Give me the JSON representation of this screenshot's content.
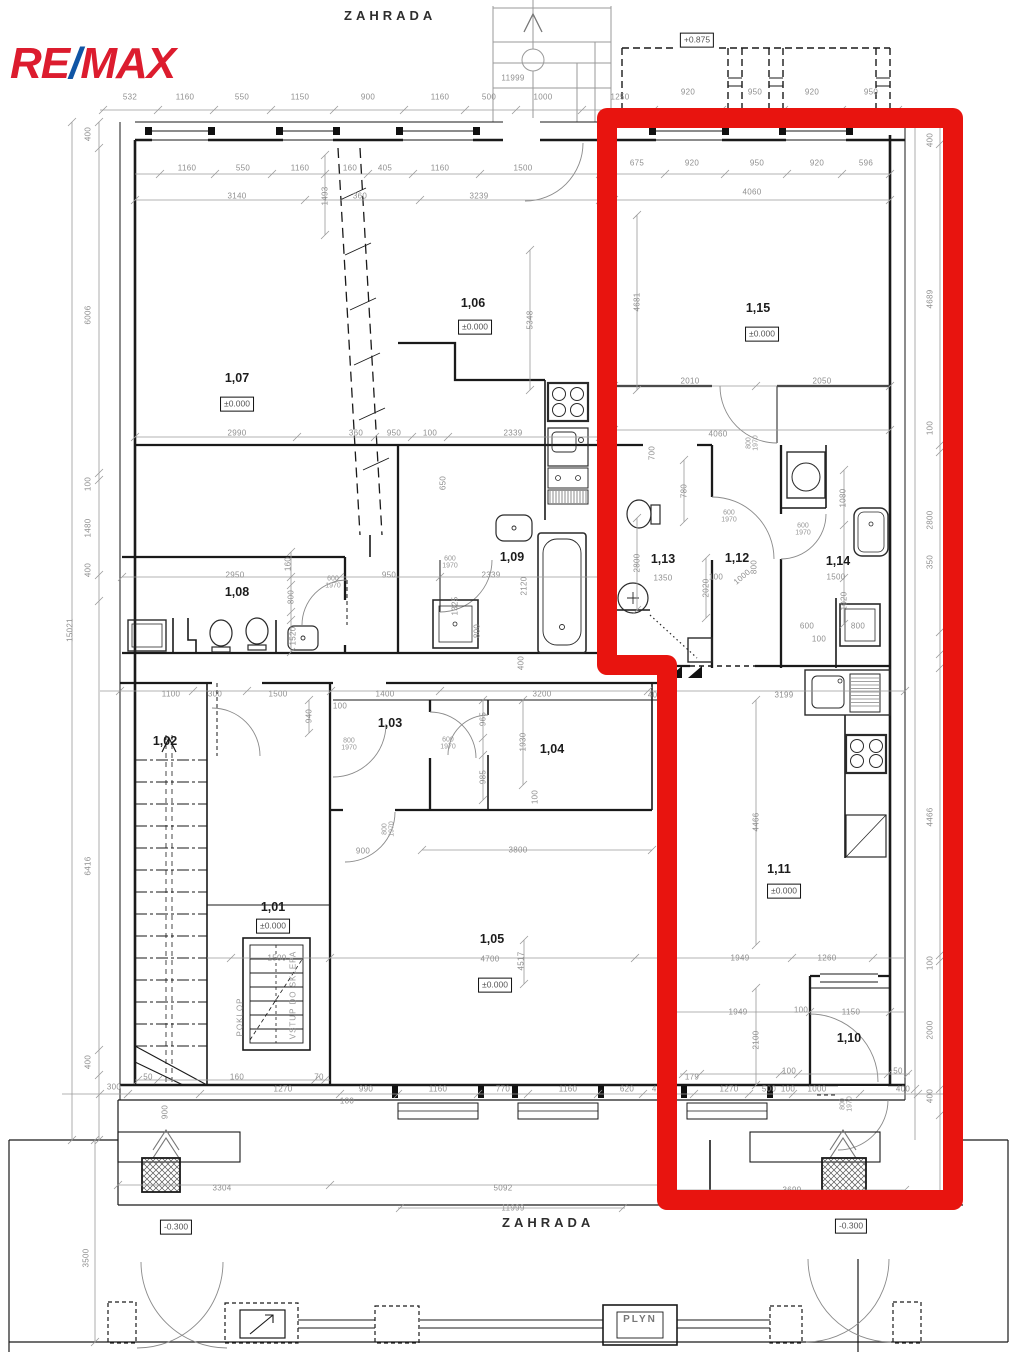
{
  "logo": {
    "re": "RE",
    "slash": "/",
    "max": "MAX"
  },
  "labels": {
    "garden_top": "ZAHRADA",
    "garden_bottom": "ZAHRADA",
    "gas_box": "PLYN"
  },
  "colors": {
    "highlight": "#e8140f",
    "logo_red": "#dc1c2e",
    "logo_blue": "#1055a5",
    "wall": "#1a1a1a",
    "dim": "#9a9a9a"
  },
  "annotations": [
    {
      "t": "1,07",
      "x": 237,
      "y": 378,
      "k": "room"
    },
    {
      "t": "±0.000",
      "x": 237,
      "y": 404,
      "k": "level"
    },
    {
      "t": "1,06",
      "x": 473,
      "y": 303,
      "k": "room"
    },
    {
      "t": "±0.000",
      "x": 475,
      "y": 327,
      "k": "level"
    },
    {
      "t": "1,15",
      "x": 758,
      "y": 308,
      "k": "room"
    },
    {
      "t": "±0.000",
      "x": 762,
      "y": 334,
      "k": "level"
    },
    {
      "t": "1,08",
      "x": 237,
      "y": 592,
      "k": "room"
    },
    {
      "t": "1,09",
      "x": 512,
      "y": 557,
      "k": "room"
    },
    {
      "t": "1,13",
      "x": 663,
      "y": 559,
      "k": "room"
    },
    {
      "t": "1,12",
      "x": 737,
      "y": 558,
      "k": "room"
    },
    {
      "t": "1,14",
      "x": 838,
      "y": 561,
      "k": "room"
    },
    {
      "t": "1,11",
      "x": 779,
      "y": 869,
      "k": "room"
    },
    {
      "t": "±0.000",
      "x": 784,
      "y": 891,
      "k": "level"
    },
    {
      "t": "1,10",
      "x": 849,
      "y": 1038,
      "k": "room"
    },
    {
      "t": "1,05",
      "x": 492,
      "y": 939,
      "k": "room"
    },
    {
      "t": "±0.000",
      "x": 495,
      "y": 985,
      "k": "level"
    },
    {
      "t": "1,01",
      "x": 273,
      "y": 907,
      "k": "room"
    },
    {
      "t": "±0.000",
      "x": 273,
      "y": 926,
      "k": "level"
    },
    {
      "t": "1,02",
      "x": 165,
      "y": 741,
      "k": "room"
    },
    {
      "t": "1,03",
      "x": 390,
      "y": 723,
      "k": "room"
    },
    {
      "t": "1,04",
      "x": 552,
      "y": 749,
      "k": "room"
    },
    {
      "t": "+0.875",
      "x": 697,
      "y": 40,
      "k": "elev"
    },
    {
      "t": "-0.300",
      "x": 176,
      "y": 1227,
      "k": "elev"
    },
    {
      "t": "-0.300",
      "x": 851,
      "y": 1226,
      "k": "elev"
    },
    {
      "t": "532",
      "x": 130,
      "y": 97
    },
    {
      "t": "1160",
      "x": 185,
      "y": 97
    },
    {
      "t": "550",
      "x": 242,
      "y": 97
    },
    {
      "t": "1150",
      "x": 300,
      "y": 97
    },
    {
      "t": "900",
      "x": 368,
      "y": 97
    },
    {
      "t": "1160",
      "x": 440,
      "y": 97
    },
    {
      "t": "500",
      "x": 489,
      "y": 97
    },
    {
      "t": "1000",
      "x": 543,
      "y": 97
    },
    {
      "t": "1250",
      "x": 620,
      "y": 97
    },
    {
      "t": "920",
      "x": 688,
      "y": 92
    },
    {
      "t": "950",
      "x": 755,
      "y": 92
    },
    {
      "t": "920",
      "x": 812,
      "y": 92
    },
    {
      "t": "950",
      "x": 871,
      "y": 92
    },
    {
      "t": "11999",
      "x": 513,
      "y": 78
    },
    {
      "t": "1160",
      "x": 187,
      "y": 168
    },
    {
      "t": "550",
      "x": 243,
      "y": 168
    },
    {
      "t": "1160",
      "x": 300,
      "y": 168
    },
    {
      "t": "160",
      "x": 350,
      "y": 168
    },
    {
      "t": "405",
      "x": 385,
      "y": 168
    },
    {
      "t": "1160",
      "x": 440,
      "y": 168
    },
    {
      "t": "1500",
      "x": 523,
      "y": 168
    },
    {
      "t": "675",
      "x": 637,
      "y": 163
    },
    {
      "t": "920",
      "x": 692,
      "y": 163
    },
    {
      "t": "950",
      "x": 757,
      "y": 163
    },
    {
      "t": "920",
      "x": 817,
      "y": 163
    },
    {
      "t": "596",
      "x": 866,
      "y": 163
    },
    {
      "t": "3140",
      "x": 237,
      "y": 196
    },
    {
      "t": "360",
      "x": 360,
      "y": 196
    },
    {
      "t": "3239",
      "x": 479,
      "y": 196
    },
    {
      "t": "4060",
      "x": 752,
      "y": 192
    },
    {
      "t": "1493",
      "x": 325,
      "y": 196,
      "k": "dimv"
    },
    {
      "t": "5348",
      "x": 530,
      "y": 320,
      "k": "dimv"
    },
    {
      "t": "4681",
      "x": 637,
      "y": 302,
      "k": "dimv"
    },
    {
      "t": "2010",
      "x": 690,
      "y": 381
    },
    {
      "t": "2050",
      "x": 822,
      "y": 381
    },
    {
      "t": "4060",
      "x": 718,
      "y": 434
    },
    {
      "t": "800|1970",
      "x": 753,
      "y": 443,
      "k": "doorv"
    },
    {
      "t": "2990",
      "x": 237,
      "y": 433
    },
    {
      "t": "360",
      "x": 356,
      "y": 433
    },
    {
      "t": "950",
      "x": 394,
      "y": 433
    },
    {
      "t": "100",
      "x": 430,
      "y": 433
    },
    {
      "t": "2339",
      "x": 513,
      "y": 433
    },
    {
      "t": "2950",
      "x": 235,
      "y": 575
    },
    {
      "t": "950",
      "x": 389,
      "y": 575
    },
    {
      "t": "2339",
      "x": 491,
      "y": 575
    },
    {
      "t": "160",
      "x": 288,
      "y": 564,
      "k": "dimv"
    },
    {
      "t": "800",
      "x": 291,
      "y": 597,
      "k": "dimv"
    },
    {
      "t": "1520",
      "x": 293,
      "y": 636,
      "k": "dimv"
    },
    {
      "t": "600|1970",
      "x": 333,
      "y": 583,
      "k": "door"
    },
    {
      "t": "650",
      "x": 443,
      "y": 483,
      "k": "dimv"
    },
    {
      "t": "600|1970",
      "x": 450,
      "y": 563,
      "k": "door"
    },
    {
      "t": "2120",
      "x": 524,
      "y": 586,
      "k": "dimv"
    },
    {
      "t": "1325",
      "x": 455,
      "y": 606,
      "k": "dimv"
    },
    {
      "t": "800",
      "x": 477,
      "y": 631,
      "k": "dimv"
    },
    {
      "t": "400",
      "x": 521,
      "y": 663,
      "k": "dimv"
    },
    {
      "t": "700",
      "x": 652,
      "y": 453,
      "k": "dimv"
    },
    {
      "t": "780",
      "x": 684,
      "y": 491,
      "k": "dimv"
    },
    {
      "t": "2800",
      "x": 637,
      "y": 563,
      "k": "dimv"
    },
    {
      "t": "1350",
      "x": 663,
      "y": 578
    },
    {
      "t": "2020",
      "x": 706,
      "y": 588,
      "k": "dimv"
    },
    {
      "t": "600|1970",
      "x": 729,
      "y": 517,
      "k": "door"
    },
    {
      "t": "1000",
      "x": 742,
      "y": 577,
      "r": -40
    },
    {
      "t": "800",
      "x": 754,
      "y": 567,
      "k": "dimv"
    },
    {
      "t": "100",
      "x": 716,
      "y": 577
    },
    {
      "t": "600|1970",
      "x": 803,
      "y": 530,
      "k": "door"
    },
    {
      "t": "1080",
      "x": 843,
      "y": 498,
      "k": "dimv"
    },
    {
      "t": "1500",
      "x": 836,
      "y": 577
    },
    {
      "t": "1020",
      "x": 844,
      "y": 601,
      "k": "dimv"
    },
    {
      "t": "600",
      "x": 807,
      "y": 626
    },
    {
      "t": "800",
      "x": 858,
      "y": 626
    },
    {
      "t": "100",
      "x": 819,
      "y": 639
    },
    {
      "t": "1100",
      "x": 171,
      "y": 694
    },
    {
      "t": "300",
      "x": 215,
      "y": 694
    },
    {
      "t": "1500",
      "x": 278,
      "y": 694
    },
    {
      "t": "1400",
      "x": 385,
      "y": 694
    },
    {
      "t": "100",
      "x": 340,
      "y": 706
    },
    {
      "t": "3200",
      "x": 542,
      "y": 694
    },
    {
      "t": "400",
      "x": 655,
      "y": 695
    },
    {
      "t": "3199",
      "x": 784,
      "y": 695
    },
    {
      "t": "940",
      "x": 309,
      "y": 716,
      "k": "dimv"
    },
    {
      "t": "800|1970",
      "x": 349,
      "y": 745,
      "k": "door"
    },
    {
      "t": "900",
      "x": 363,
      "y": 851
    },
    {
      "t": "800|1970",
      "x": 389,
      "y": 829,
      "k": "doorv"
    },
    {
      "t": "600|1970",
      "x": 448,
      "y": 744,
      "k": "door"
    },
    {
      "t": "965",
      "x": 483,
      "y": 719,
      "k": "dimv"
    },
    {
      "t": "1930",
      "x": 523,
      "y": 742,
      "k": "dimv"
    },
    {
      "t": "985",
      "x": 483,
      "y": 777,
      "k": "dimv"
    },
    {
      "t": "100",
      "x": 535,
      "y": 797,
      "k": "dimv"
    },
    {
      "t": "3800",
      "x": 518,
      "y": 850
    },
    {
      "t": "4700",
      "x": 490,
      "y": 959
    },
    {
      "t": "4517",
      "x": 521,
      "y": 961,
      "k": "dimv"
    },
    {
      "t": "1500",
      "x": 277,
      "y": 958
    },
    {
      "t": "1949",
      "x": 740,
      "y": 958
    },
    {
      "t": "1260",
      "x": 827,
      "y": 958
    },
    {
      "t": "1949",
      "x": 738,
      "y": 1012
    },
    {
      "t": "100",
      "x": 801,
      "y": 1010
    },
    {
      "t": "1150",
      "x": 851,
      "y": 1012
    },
    {
      "t": "2100",
      "x": 756,
      "y": 1040,
      "k": "dimv"
    },
    {
      "t": "4466",
      "x": 756,
      "y": 822,
      "k": "dimv"
    },
    {
      "t": "POKLOP",
      "x": 240,
      "y": 1017,
      "k": "vtext"
    },
    {
      "t": "VSTUP DO SKLEPA",
      "x": 293,
      "y": 995,
      "k": "vtext"
    },
    {
      "t": "179",
      "x": 692,
      "y": 1077
    },
    {
      "t": "100",
      "x": 789,
      "y": 1071
    },
    {
      "t": "50",
      "x": 898,
      "y": 1071
    },
    {
      "t": "50",
      "x": 148,
      "y": 1077
    },
    {
      "t": "160",
      "x": 237,
      "y": 1077
    },
    {
      "t": "70",
      "x": 319,
      "y": 1077
    },
    {
      "t": "300",
      "x": 114,
      "y": 1087
    },
    {
      "t": "900",
      "x": 165,
      "y": 1112,
      "k": "dimv"
    },
    {
      "t": "1270",
      "x": 283,
      "y": 1089
    },
    {
      "t": "990",
      "x": 366,
      "y": 1089
    },
    {
      "t": "1160",
      "x": 438,
      "y": 1089
    },
    {
      "t": "770",
      "x": 503,
      "y": 1089
    },
    {
      "t": "1160",
      "x": 568,
      "y": 1089
    },
    {
      "t": "620",
      "x": 627,
      "y": 1089
    },
    {
      "t": "400",
      "x": 659,
      "y": 1089
    },
    {
      "t": "1270",
      "x": 729,
      "y": 1089
    },
    {
      "t": "500",
      "x": 769,
      "y": 1089
    },
    {
      "t": "100",
      "x": 788,
      "y": 1089
    },
    {
      "t": "1000",
      "x": 817,
      "y": 1089
    },
    {
      "t": "400",
      "x": 903,
      "y": 1089
    },
    {
      "t": "100",
      "x": 347,
      "y": 1101
    },
    {
      "t": "800|1970",
      "x": 847,
      "y": 1104,
      "k": "doorv"
    },
    {
      "t": "400",
      "x": 88,
      "y": 134,
      "k": "dimv"
    },
    {
      "t": "6006",
      "x": 88,
      "y": 315,
      "k": "dimv"
    },
    {
      "t": "100",
      "x": 88,
      "y": 484,
      "k": "dimv"
    },
    {
      "t": "1480",
      "x": 88,
      "y": 528,
      "k": "dimv"
    },
    {
      "t": "400",
      "x": 88,
      "y": 570,
      "k": "dimv"
    },
    {
      "t": "6416",
      "x": 88,
      "y": 866,
      "k": "dimv"
    },
    {
      "t": "400",
      "x": 88,
      "y": 1062,
      "k": "dimv"
    },
    {
      "t": "15021",
      "x": 70,
      "y": 630,
      "k": "dimv"
    },
    {
      "t": "3500",
      "x": 86,
      "y": 1258,
      "k": "dimv"
    },
    {
      "t": "400",
      "x": 930,
      "y": 140,
      "k": "dimv"
    },
    {
      "t": "4689",
      "x": 930,
      "y": 299,
      "k": "dimv"
    },
    {
      "t": "100",
      "x": 930,
      "y": 428,
      "k": "dimv"
    },
    {
      "t": "2800",
      "x": 930,
      "y": 520,
      "k": "dimv"
    },
    {
      "t": "350",
      "x": 930,
      "y": 562,
      "k": "dimv"
    },
    {
      "t": "4466",
      "x": 930,
      "y": 817,
      "k": "dimv"
    },
    {
      "t": "100",
      "x": 930,
      "y": 963,
      "k": "dimv"
    },
    {
      "t": "2000",
      "x": 930,
      "y": 1030,
      "k": "dimv"
    },
    {
      "t": "400",
      "x": 930,
      "y": 1096,
      "k": "dimv"
    },
    {
      "t": "14962",
      "x": 947,
      "y": 650,
      "k": "dimv"
    },
    {
      "t": "3304",
      "x": 222,
      "y": 1188
    },
    {
      "t": "5092",
      "x": 503,
      "y": 1188
    },
    {
      "t": "11999",
      "x": 513,
      "y": 1208
    },
    {
      "t": "3699",
      "x": 792,
      "y": 1190
    }
  ],
  "dim_chains": [
    {
      "d": "h",
      "p": 110,
      "a": 100,
      "b": 948,
      "t": [
        103,
        158,
        214,
        271,
        334,
        404,
        465,
        516,
        582,
        654,
        722,
        784,
        842,
        898
      ]
    },
    {
      "d": "h",
      "p": 174,
      "a": 135,
      "b": 890,
      "t": [
        160,
        215,
        272,
        325,
        368,
        413,
        480,
        600,
        665,
        725,
        787,
        842,
        890
      ]
    },
    {
      "d": "h",
      "p": 200,
      "a": 135,
      "b": 890,
      "t": [
        135,
        305,
        420,
        600,
        614,
        890
      ]
    },
    {
      "d": "h",
      "p": 386,
      "a": 614,
      "b": 890,
      "t": [
        614,
        756,
        890
      ]
    },
    {
      "d": "h",
      "p": 430,
      "a": 614,
      "b": 890,
      "t": [
        614,
        890
      ]
    },
    {
      "d": "h",
      "p": 437,
      "a": 135,
      "b": 600,
      "t": [
        135,
        297,
        375,
        412,
        448,
        600
      ]
    },
    {
      "d": "h",
      "p": 577,
      "a": 122,
      "b": 608,
      "t": [
        122,
        340,
        440,
        608
      ]
    },
    {
      "d": "h",
      "p": 691,
      "a": 100,
      "b": 905,
      "t": [
        120,
        193,
        247,
        331,
        440,
        648,
        668,
        905
      ]
    },
    {
      "d": "h",
      "p": 850,
      "a": 422,
      "b": 652,
      "t": [
        422,
        652
      ]
    },
    {
      "d": "h",
      "p": 958,
      "a": 207,
      "b": 905,
      "t": [
        231,
        330,
        635,
        667,
        792,
        873
      ]
    },
    {
      "d": "h",
      "p": 1012,
      "a": 667,
      "b": 905,
      "t": [
        667,
        810,
        890
      ]
    },
    {
      "d": "h",
      "p": 1080,
      "a": 135,
      "b": 330,
      "t": [
        138,
        158,
        315,
        325
      ]
    },
    {
      "d": "h",
      "p": 1074,
      "a": 680,
      "b": 910,
      "t": [
        683,
        700,
        780,
        798,
        888,
        908
      ]
    },
    {
      "d": "h",
      "p": 1094,
      "a": 62,
      "b": 948,
      "t": [
        100,
        128,
        200,
        340,
        398,
        478,
        528,
        598,
        643,
        672,
        694,
        749,
        793,
        860,
        918
      ]
    },
    {
      "d": "h",
      "p": 1185,
      "a": 118,
      "b": 663,
      "t": [
        118,
        330,
        663
      ]
    },
    {
      "d": "h",
      "p": 1190,
      "a": 663,
      "b": 905,
      "t": [
        667,
        905
      ]
    },
    {
      "d": "h",
      "p": 1208,
      "a": 398,
      "b": 625,
      "t": [
        400,
        623
      ]
    },
    {
      "d": "v",
      "p": 99,
      "a": 122,
      "b": 1140,
      "t": [
        122,
        148,
        473,
        480,
        575,
        601,
        1050,
        1075,
        1140
      ]
    },
    {
      "d": "v",
      "p": 72,
      "a": 122,
      "b": 1140,
      "t": [
        122,
        1140
      ]
    },
    {
      "d": "v",
      "p": 95,
      "a": 1140,
      "b": 1342,
      "t": [
        1140,
        1342
      ]
    },
    {
      "d": "v",
      "p": 940,
      "a": 118,
      "b": 1205,
      "t": [
        118,
        144,
        445,
        452,
        632,
        654,
        668,
        955,
        961,
        1089,
        1115
      ]
    },
    {
      "d": "v",
      "p": 915,
      "a": 118,
      "b": 1140,
      "t": [
        118,
        1089
      ]
    },
    {
      "d": "v",
      "p": 637,
      "a": 215,
      "b": 390,
      "t": [
        215,
        390
      ]
    },
    {
      "d": "v",
      "p": 530,
      "a": 250,
      "b": 390,
      "t": [
        250,
        390
      ]
    },
    {
      "d": "v",
      "p": 325,
      "a": 155,
      "b": 235,
      "t": [
        155,
        235
      ]
    },
    {
      "d": "v",
      "p": 756,
      "a": 700,
      "b": 945,
      "t": [
        700,
        945
      ]
    },
    {
      "d": "v",
      "p": 756,
      "a": 988,
      "b": 1085,
      "t": [
        988,
        1085
      ]
    },
    {
      "d": "v",
      "p": 523,
      "a": 700,
      "b": 785,
      "t": [
        700,
        785
      ]
    },
    {
      "d": "v",
      "p": 483,
      "a": 700,
      "b": 800,
      "t": [
        700,
        738,
        755,
        800
      ]
    },
    {
      "d": "v",
      "p": 291,
      "a": 552,
      "b": 652,
      "t": [
        552,
        577,
        585,
        612,
        620,
        652
      ]
    },
    {
      "d": "v",
      "p": 844,
      "a": 470,
      "b": 624,
      "t": [
        470,
        525,
        578,
        624
      ]
    },
    {
      "d": "v",
      "p": 684,
      "a": 460,
      "b": 522,
      "t": [
        460,
        522
      ]
    },
    {
      "d": "v",
      "p": 706,
      "a": 558,
      "b": 618,
      "t": [
        558,
        618
      ]
    },
    {
      "d": "v",
      "p": 637,
      "a": 518,
      "b": 610,
      "t": [
        518,
        610
      ]
    },
    {
      "d": "v",
      "p": 309,
      "a": 700,
      "b": 733,
      "t": [
        700,
        733
      ]
    },
    {
      "d": "v",
      "p": 524,
      "a": 940,
      "b": 984,
      "t": [
        940,
        984
      ]
    }
  ]
}
